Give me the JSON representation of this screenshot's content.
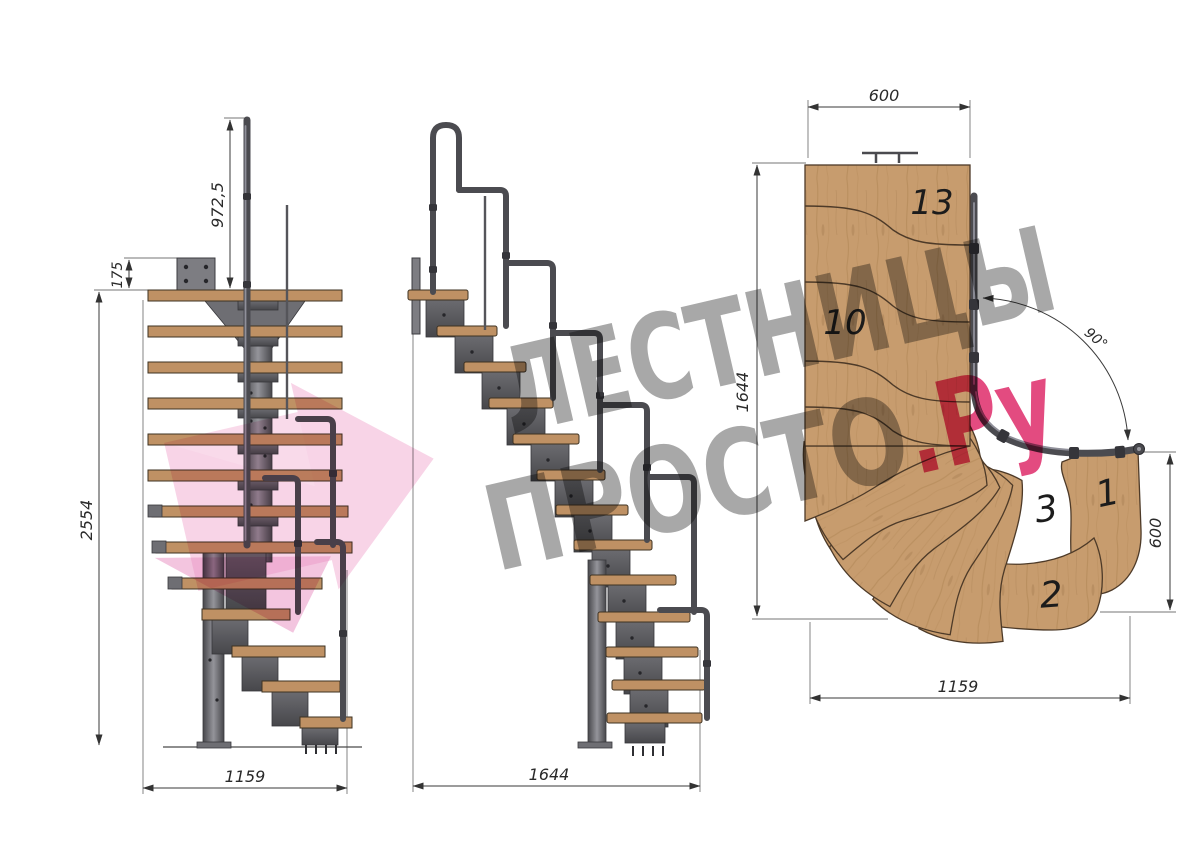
{
  "drawing": {
    "type": "modular-stair-technical-drawing"
  },
  "watermark": {
    "line1": "ЛЕСТНИЦЫ",
    "line2": "ПРОСТО",
    "suffix": ".Ру"
  },
  "views": {
    "front": {
      "dims": {
        "rail_height": "972,5",
        "plate_offset": "175",
        "total_height": "2554",
        "base_width": "1159"
      }
    },
    "side": {
      "dims": {
        "total_run": "1644"
      }
    },
    "plan": {
      "dims": {
        "top_width": "600",
        "left_depth": "1644",
        "turn_angle": "90°",
        "right_height": "600",
        "bottom_width": "1159"
      },
      "steps": {
        "s13": "13",
        "s10": "10",
        "s3": "3",
        "s1": "1",
        "s2": "2"
      }
    }
  },
  "colors": {
    "wood": "#c79c6e",
    "wood_outline": "#4d3a28",
    "steel": "#5a5a5e",
    "steel_light": "#8d8d92",
    "dimension": "#3a3a3a",
    "watermark_gray": "#a8a8a8",
    "watermark_pink": "#e34b80",
    "watermark_arrow": "#f3b5d6",
    "background": "#ffffff"
  }
}
